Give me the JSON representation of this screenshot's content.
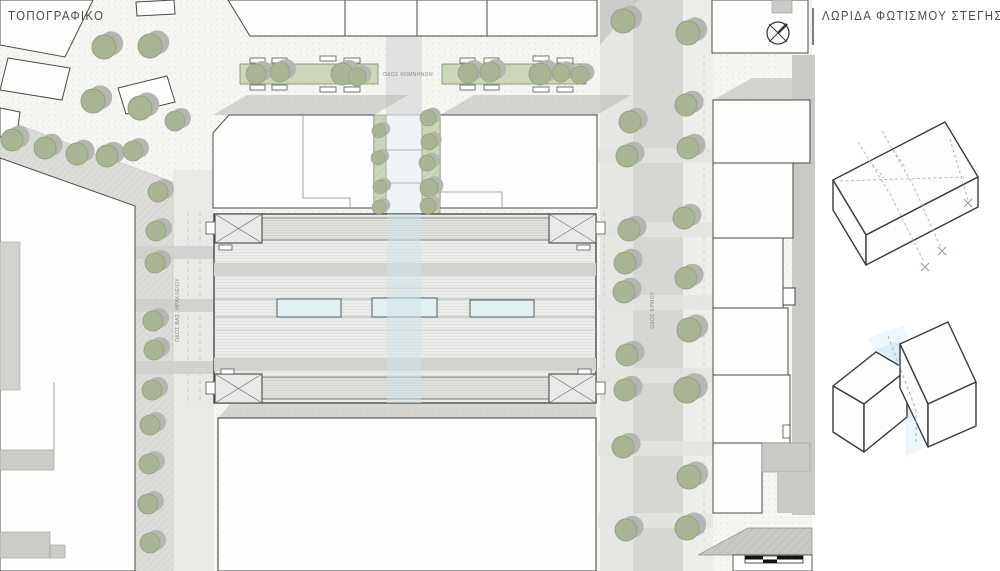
{
  "titles": {
    "plan": "ΤΟΠΟΓΡΑΦΙΚΟ",
    "panel": "ΛΩΡΙΔΑ ΦΩΤΙΣΜΟΥ ΣΤΕΓΗΣ"
  },
  "streets": {
    "top_label": "ΟΔΟΣ ΚΟΜΝΗΝΩΝ",
    "left_label": "ΟΔΟΣ ΒΑΣ. ΗΡΑΚΛΕΙΟΥ",
    "right_label": "ΟΔΟΣ ΕΡΜΟΥ"
  },
  "icons": {
    "north_arrow": "north-arrow-icon",
    "scale_bar": "scale-bar"
  },
  "colors": {
    "tree_green": "#a8b493",
    "planter_green": "#ccd6ba",
    "roof_gray": "#ececea",
    "shadow_gray": "#b8b8b5",
    "skylight_blue": "#e3f0f2",
    "light_strip_blue": "#cde4ea",
    "line_dark": "#4a4a4a"
  }
}
